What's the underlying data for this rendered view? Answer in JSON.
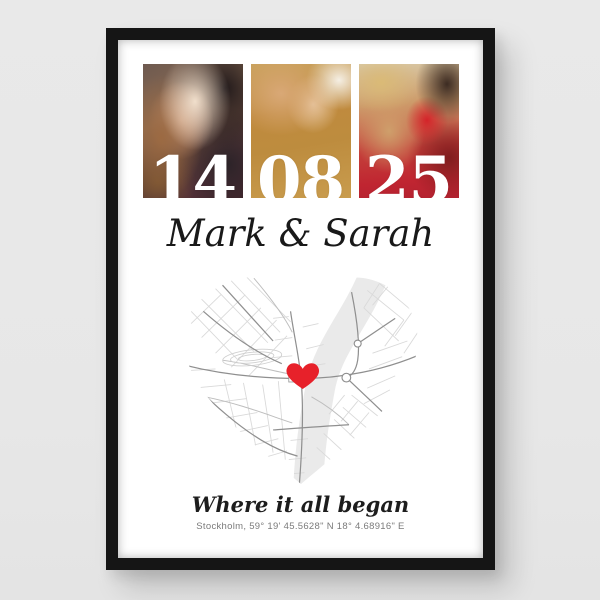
{
  "scene": {
    "background_color": "#e8e8e8",
    "frame_color": "#151515",
    "poster_color": "#ffffff"
  },
  "poster": {
    "date": {
      "day": "14",
      "month": "08",
      "year": "25"
    },
    "photos": [
      {
        "name": "couple-kissing",
        "date_part": "14"
      },
      {
        "name": "pinky-promise-hands",
        "date_part": "08"
      },
      {
        "name": "couple-with-rose",
        "date_part": "25"
      }
    ],
    "names": "Mark & Sarah",
    "tagline": "Where it all began",
    "coordinates": "Stockholm, 59° 19' 45.5628\" N 18° 4.68916\" E",
    "map": {
      "shape": "heart",
      "city": "Stockholm",
      "marker": "heart-location-marker",
      "marker_color": "#e7212a",
      "river_color": "#eaeaea",
      "road_major_color": "#8f8f8f",
      "road_minor_color": "#d9d9d9"
    }
  }
}
